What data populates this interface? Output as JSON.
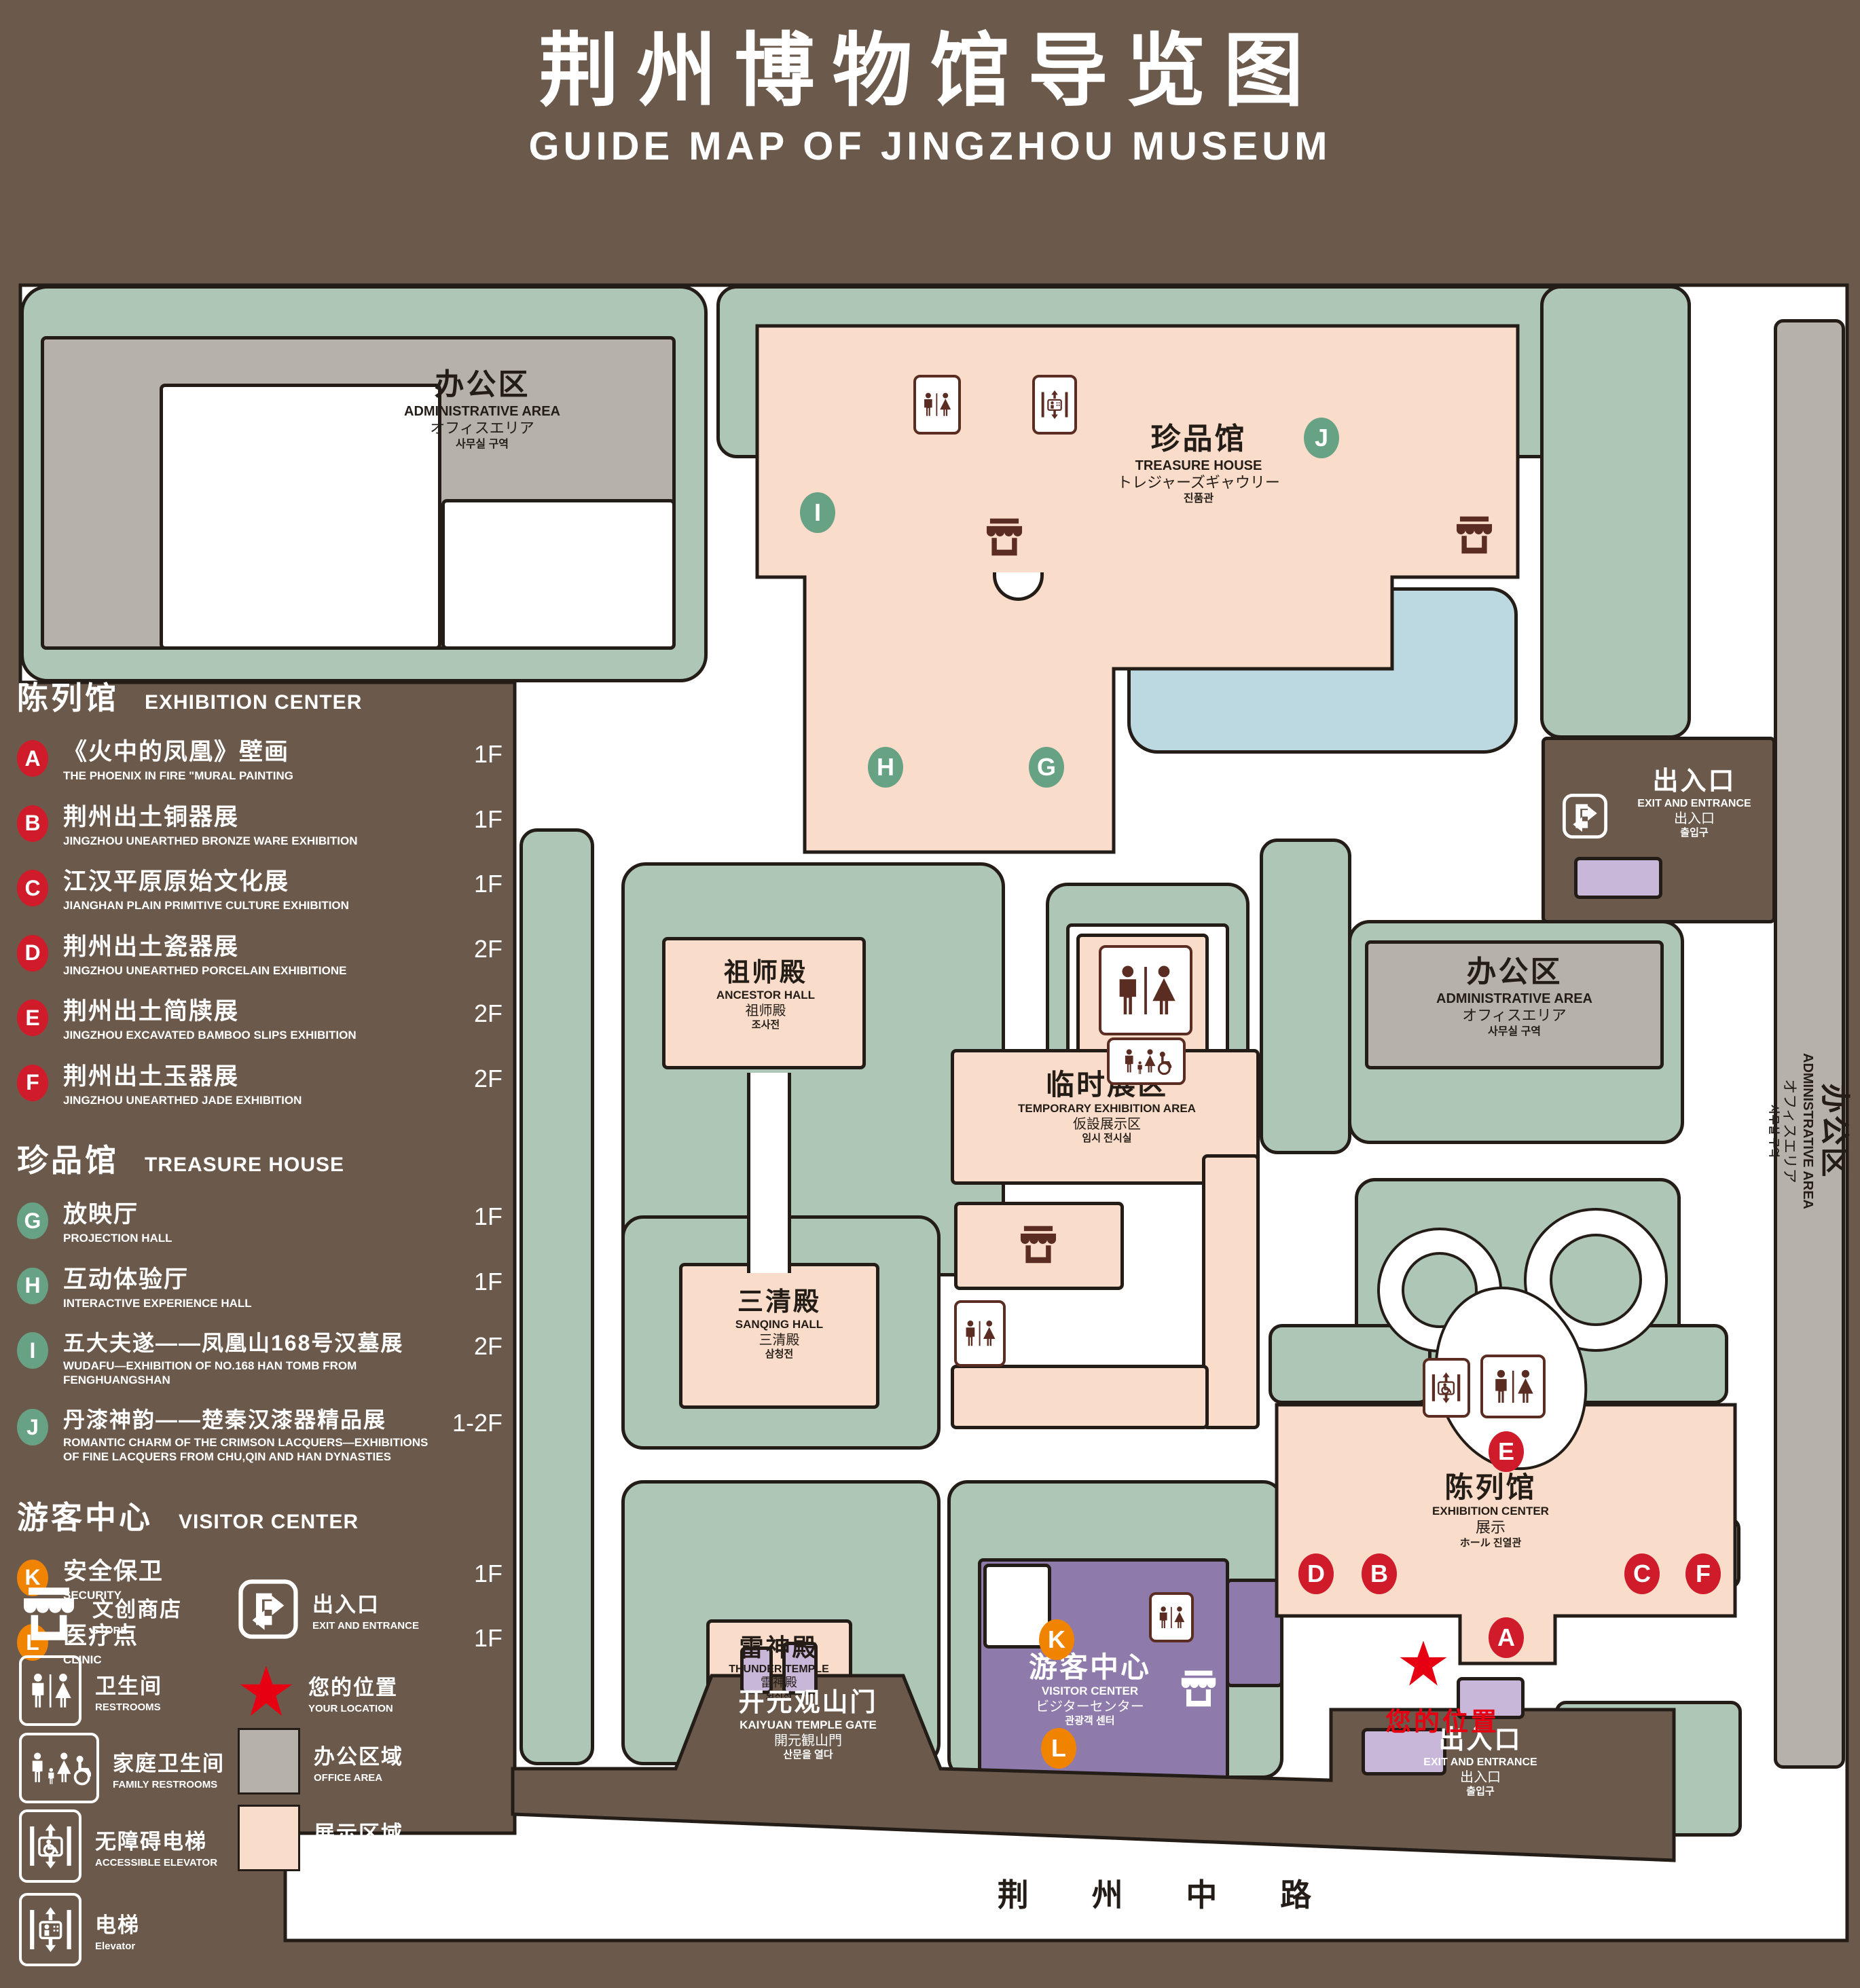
{
  "title": {
    "zh": "荆州博物馆导览图",
    "en": "GUIDE MAP OF JINGZHOU MUSEUM"
  },
  "legend": {
    "sections": [
      {
        "zh": "陈列馆",
        "en": "EXHIBITION CENTER",
        "items": [
          {
            "letter": "A",
            "zh": "《火中的凤凰》壁画",
            "en": "THE PHOENIX IN FIRE \"MURAL PAINTING",
            "floor": "1F"
          },
          {
            "letter": "B",
            "zh": "荆州出土铜器展",
            "en": "JINGZHOU UNEARTHED BRONZE WARE EXHIBITION",
            "floor": "1F"
          },
          {
            "letter": "C",
            "zh": "江汉平原原始文化展",
            "en": "JIANGHAN PLAIN PRIMITIVE CULTURE EXHIBITION",
            "floor": "1F"
          },
          {
            "letter": "D",
            "zh": "荆州出土瓷器展",
            "en": "JINGZHOU UNEARTHED PORCELAIN EXHIBITIONE",
            "floor": "2F"
          },
          {
            "letter": "E",
            "zh": "荆州出土简牍展",
            "en": "JINGZHOU EXCAVATED BAMBOO SLIPS EXHIBITION",
            "floor": "2F"
          },
          {
            "letter": "F",
            "zh": "荆州出土玉器展",
            "en": "JINGZHOU UNEARTHED JADE EXHIBITION",
            "floor": "2F"
          }
        ]
      },
      {
        "zh": "珍品馆",
        "en": "TREASURE HOUSE",
        "items": [
          {
            "letter": "G",
            "zh": "放映厅",
            "en": "PROJECTION HALL",
            "floor": "1F"
          },
          {
            "letter": "H",
            "zh": "互动体验厅",
            "en": "INTERACTIVE EXPERIENCE HALL",
            "floor": "1F"
          },
          {
            "letter": "I",
            "zh": "五大夫遂——凤凰山168号汉墓展",
            "en": "WUDAFU—EXHIBITION OF NO.168 HAN TOMB FROM FENGHUANGSHAN",
            "floor": "2F"
          },
          {
            "letter": "J",
            "zh": "丹漆神韵——楚秦汉漆器精品展",
            "en": "ROMANTIC CHARM OF THE CRIMSON LACQUERS—EXHIBITIONS OF FINE LACQUERS FROM CHU,QIN AND HAN DYNASTIES",
            "floor": "1-2F"
          }
        ]
      },
      {
        "zh": "游客中心",
        "en": "VISITOR CENTER",
        "items": [
          {
            "letter": "K",
            "zh": "安全保卫",
            "en": "SECURITY",
            "floor": "1F"
          },
          {
            "letter": "L",
            "zh": "医疗点",
            "en": "CLINIC",
            "floor": "1F"
          }
        ]
      }
    ],
    "symbols": [
      {
        "zh": "文创商店",
        "en": "STORE"
      },
      {
        "zh": "出入口",
        "en": "EXIT AND ENTRANCE"
      },
      {
        "zh": "卫生间",
        "en": "RESTROOMS"
      },
      {
        "zh": "您的位置",
        "en": "YOUR LOCATION"
      },
      {
        "zh": "家庭卫生间",
        "en": "FAMILY RESTROOMS"
      },
      {
        "zh": "办公区域",
        "en": "OFFICE AREA"
      },
      {
        "zh": "无障碍电梯",
        "en": "ACCESSIBLE ELEVATOR"
      },
      {
        "zh": "展示区域",
        "en": "DISPLAY AREA"
      },
      {
        "zh": "电梯",
        "en": "Elevator"
      }
    ]
  },
  "map": {
    "admin": {
      "zh": "办公区",
      "en": "ADMINISTRATIVE AREA",
      "ja": "オフィスエリア",
      "ko": "사무실 구역"
    },
    "treasure": {
      "zh": "珍品馆",
      "en": "TREASURE HOUSE",
      "ja": "トレジャーズギャウリー",
      "ko": "진품관"
    },
    "ancestor": {
      "zh": "祖师殿",
      "en": "ANCESTOR HALL",
      "ja": "祖师殿",
      "ko": "조사전"
    },
    "temporary": {
      "zh": "临时展区",
      "en": "TEMPORARY EXHIBITION AREA",
      "ja": "仮設展示区",
      "ko": "임시 전시실"
    },
    "sanqing": {
      "zh": "三清殿",
      "en": "SANQING HALL",
      "ja": "三清殿",
      "ko": "삼청전"
    },
    "thunder": {
      "zh": "雷神殿",
      "en": "THUNDER TEMPLE",
      "ja": "雷神殿",
      "ko": "뇌신전"
    },
    "visitor": {
      "zh": "游客中心",
      "en": "VISITOR CENTER",
      "ja": "ビジターセンター",
      "ko": "관광객 센터"
    },
    "exhibition": {
      "zh": "陈列馆",
      "en": "EXHIBITION CENTER",
      "line3": "展示",
      "line4": "ホール 진열관"
    },
    "gate": {
      "zh": "开元观山门",
      "en": "KAIYUAN TEMPLE GATE",
      "ja": "開元観山門",
      "ko": "산문을 열다"
    },
    "exit": {
      "zh": "出入口",
      "en": "EXIT AND ENTRANCE",
      "ja": "出入口",
      "ko": "출입구"
    },
    "road": "荆 州 中 路",
    "your_location": "您的位置",
    "badges": {
      "a": "A",
      "b": "B",
      "c": "C",
      "d": "D",
      "e": "E",
      "f": "F",
      "g": "G",
      "h": "H",
      "i": "I",
      "j": "J",
      "k": "K",
      "l": "L"
    },
    "colors": {
      "display_area": "#f9dcc9",
      "office_area": "#b7b1ac",
      "green": "#aec6b5",
      "water": "#bcd9e2",
      "visitor_purple": "#8f7bab",
      "badge_red": "#cf1b2a",
      "badge_green": "#68a284",
      "badge_orange": "#f08300",
      "location_red": "#e60012",
      "background": "#6b5a4c"
    }
  }
}
